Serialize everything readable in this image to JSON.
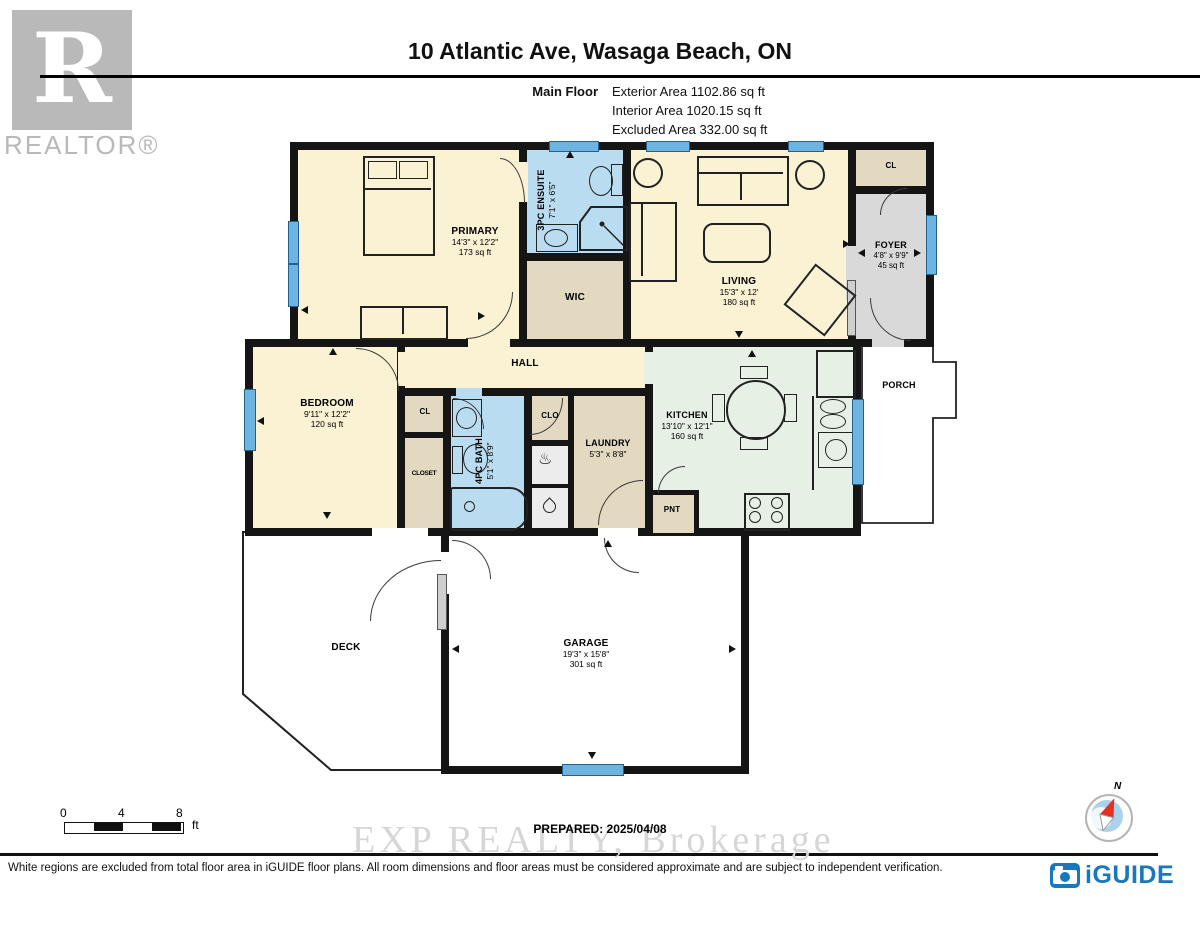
{
  "header": {
    "title": "10 Atlantic Ave, Wasaga Beach, ON",
    "floor_label": "Main Floor",
    "stats": {
      "exterior": "Exterior Area 1102.86 sq ft",
      "interior": "Interior Area 1020.15 sq ft",
      "excluded": "Excluded Area 332.00 sq ft"
    }
  },
  "brand": {
    "realtor": "REALTOR®",
    "realtor_r": "R",
    "iguide": "iGUIDE"
  },
  "rooms": {
    "primary": {
      "name": "PRIMARY",
      "dims": "14'3\" x 12'2\"",
      "area": "173 sq ft"
    },
    "ensuite": {
      "name": "3PC ENSUITE",
      "dims": "7'1\" x 6'5\""
    },
    "wic": {
      "name": "WIC"
    },
    "living": {
      "name": "LIVING",
      "dims": "15'3\" x 12'",
      "area": "180 sq ft"
    },
    "foyer_closet": {
      "name": "CL"
    },
    "foyer": {
      "name": "FOYER",
      "dims": "4'8\" x 9'9\"",
      "area": "45 sq ft"
    },
    "hall": {
      "name": "HALL"
    },
    "bedroom": {
      "name": "BEDROOM",
      "dims": "9'11\" x 12'2\"",
      "area": "120 sq ft"
    },
    "bedroom_cl": {
      "name": "CL"
    },
    "bedroom_closet": {
      "name": "CLOSET"
    },
    "bath": {
      "name": "4PC BATH",
      "dims": "5'1\" x 8'9\""
    },
    "clo": {
      "name": "CLO"
    },
    "laundry": {
      "name": "LAUNDRY",
      "dims": "5'3\" x 8'8\""
    },
    "kitchen": {
      "name": "KITCHEN",
      "dims": "13'10\" x 12'1\"",
      "area": "160 sq ft"
    },
    "pantry": {
      "name": "PNT"
    },
    "porch": {
      "name": "PORCH"
    },
    "deck": {
      "name": "DECK"
    },
    "garage": {
      "name": "GARAGE",
      "dims": "19'3\" x 15'8\"",
      "area": "301 sq ft"
    }
  },
  "footer": {
    "prepared": "PREPARED: 2025/04/08",
    "watermark": "EXP REALTY, Brokerage",
    "disclaimer": "White regions are excluded from total floor area in iGUIDE floor plans. All room dimensions and floor areas must be considered approximate and are subject to independent verification.",
    "scale": {
      "t0": "0",
      "t1": "4",
      "t2": "8",
      "unit": "ft"
    },
    "compass_n": "N"
  },
  "icons": {
    "furnace": "♨"
  },
  "colors": {
    "wall": "#151515",
    "room_cream": "#fbf2d4",
    "room_blue": "#b9dcf0",
    "room_tan": "#e3d9c1",
    "room_gray": "#d9d9d9",
    "room_mint": "#e7f0e4",
    "window_blue": "#6db4e0",
    "brand_blue": "#1878be",
    "compass_red": "#e33022",
    "logo_gray": "#b9b9b9"
  }
}
